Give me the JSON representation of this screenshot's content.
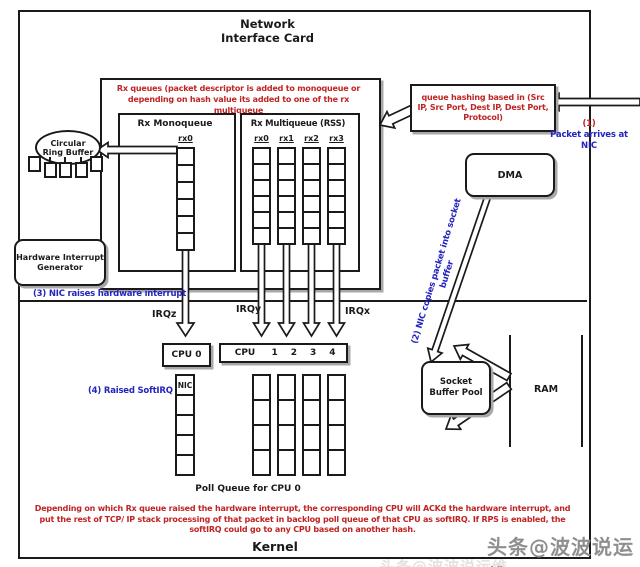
{
  "colors": {
    "red": "#bf2424",
    "blue": "#2424bf",
    "ink": "#1a1a1a",
    "watermark": "#8f8f8f"
  },
  "nic": {
    "title": "Network\nInterface Card"
  },
  "kernel": {
    "label": "Kernel"
  },
  "ring_buffer": {
    "label": "Circular\nRing Buffer"
  },
  "rx_area": {
    "note": "Rx queues (packet descriptor is added to monoqueue or\ndepending on hash value its added to one of the rx multiqueue",
    "monoqueue": {
      "title": "Rx Monoqueue",
      "queues": [
        {
          "label": "rx0",
          "cells": 6
        }
      ]
    },
    "multiqueue": {
      "title": "Rx Multiqueue (RSS)",
      "queues": [
        {
          "label": "rx0",
          "cells": 6
        },
        {
          "label": "rx1",
          "cells": 6
        },
        {
          "label": "rx2",
          "cells": 6
        },
        {
          "label": "rx3",
          "cells": 6
        }
      ]
    }
  },
  "hash_box": {
    "text": "queue hashing based in (Src\nIP, Src Port, Dest IP, Dest Port,\nProtocol)"
  },
  "steps": {
    "s1_num": "(1)",
    "s1_text": "Packet arrives at",
    "s1_text2": "NIC",
    "s2": "(2)  NIC copies packet into socket\nbuffer",
    "s3": "(3) NIC raises hardware interrupt",
    "s4": "(4) Raised SoftIRQ"
  },
  "boxes": {
    "hw_gen": "Hardware Interrupt\nGenerator",
    "dma": "DMA",
    "socket_pool": "Socket\nBuffer Pool",
    "ram": "RAM"
  },
  "irq_labels": {
    "z": "IRQz",
    "y": "IRQy",
    "x": "IRQx"
  },
  "cpu": {
    "cpu0": "CPU 0",
    "row": [
      "CPU",
      "1",
      "2",
      "3",
      "4"
    ]
  },
  "poll": {
    "nic_cell": "NIC",
    "cpu0_queue_label": "Poll Queue for CPU 0",
    "cpu0_cells": 5,
    "other_cells": 4
  },
  "bottom_note": "Depending on which Rx queue raised the hardware interrupt, the corresponding CPU will ACKd the hardware interrupt, and put the rest of TCP/ IP stack processing of that packet in backlog poll queue of that CPU as softIRQ. If RPS is enabled, the softIRQ could go to any CPU based on another hash.",
  "watermark": "头条@波波说运维"
}
